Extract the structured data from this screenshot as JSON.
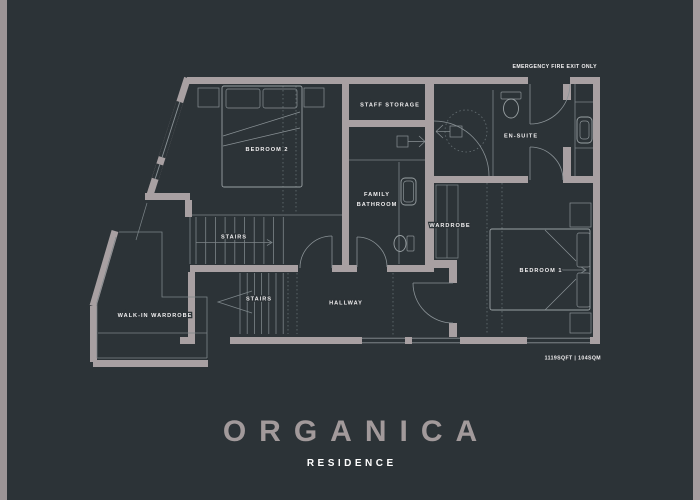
{
  "colors": {
    "background": "#2c3337",
    "wall": "#a8a0a2",
    "thin_line": "#7c8589",
    "label_text": "#f2f0f1",
    "title_text": "#a29a9b",
    "subtitle_text": "#ffffff",
    "edge_left": "#9c9496",
    "edge_right": "#a49c9e"
  },
  "plan": {
    "exit_label": "EMERGENCY FIRE EXIT ONLY",
    "area_label": "1119SQFT | 104SQM",
    "labels": {
      "staff_storage": "STAFF STORAGE",
      "en_suite": "EN-SUITE",
      "bedroom_2": "BEDROOM 2",
      "family_bathroom_line1": "FAMILY",
      "family_bathroom_line2": "BATHROOM",
      "wardrobe": "WARDROBE",
      "bedroom_1": "BEDROOM 1",
      "stairs_upper": "STAIRS",
      "stairs_lower": "STAIRS",
      "hallway": "HALLWAY",
      "walk_in_wardrobe": "WALK-IN WARDROBE"
    }
  },
  "title": {
    "name": "ORGANICA",
    "subtitle": "RESIDENCE"
  }
}
